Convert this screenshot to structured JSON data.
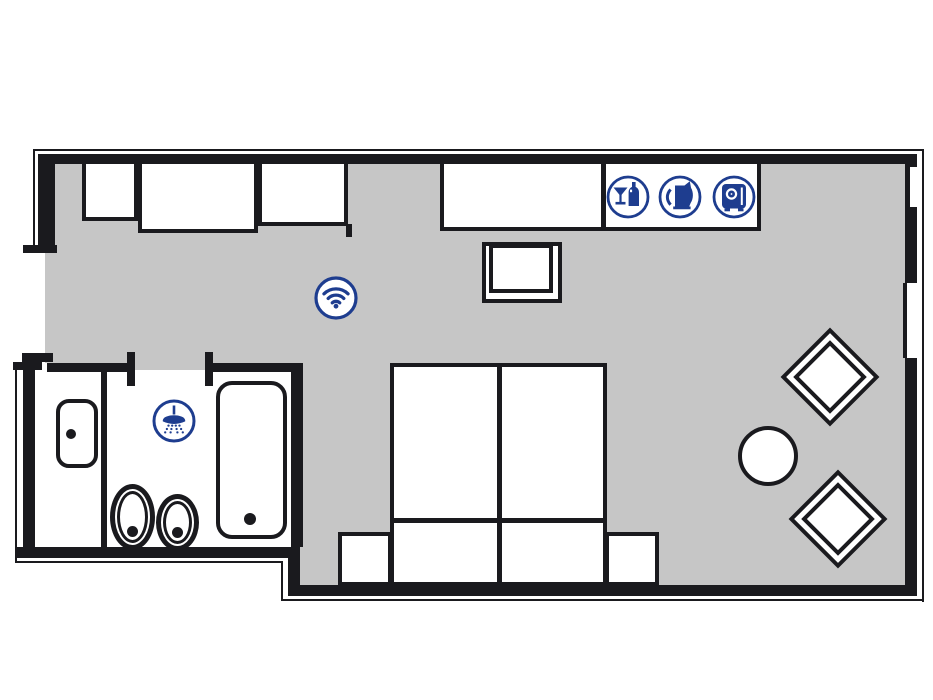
{
  "colors": {
    "wall": "#1a1a1e",
    "floor": "#c6c6c6",
    "accent": "#1e3d8f"
  },
  "plan": {
    "type": "hotel-room-floor-plan",
    "amenity_icons": [
      {
        "id": "minibar",
        "label": "Minibar"
      },
      {
        "id": "kettle",
        "label": "Kettle"
      },
      {
        "id": "safe",
        "label": "Safe"
      }
    ],
    "room_icons": [
      {
        "id": "wifi",
        "label": "WiFi"
      },
      {
        "id": "shower",
        "label": "Shower"
      }
    ],
    "furniture": [
      "wardrobe",
      "closet",
      "cabinet",
      "console-desk",
      "desk-chair",
      "double-bed",
      "nightstand-left",
      "nightstand-right",
      "round-table",
      "armchair-upper",
      "armchair-lower"
    ],
    "bathroom_fixtures": [
      "washbasin",
      "toilet",
      "bidet",
      "bathtub"
    ]
  }
}
